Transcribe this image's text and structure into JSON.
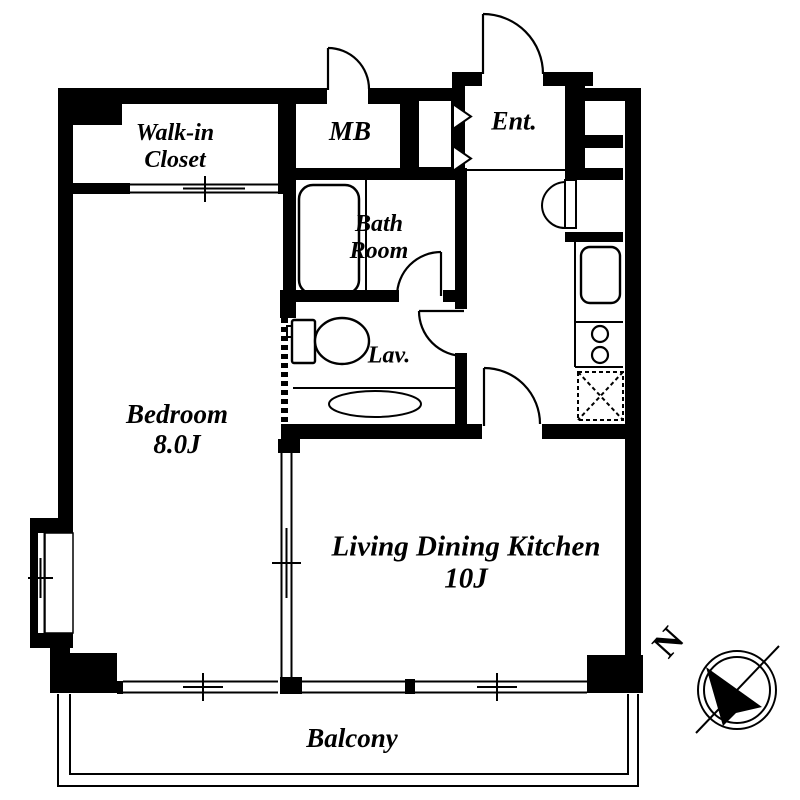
{
  "page": {
    "title": "Apartment Floor Plan"
  },
  "rooms": {
    "walk_in_closet": {
      "line1": "Walk-in",
      "line2": "Closet"
    },
    "meter_box": {
      "label": "MB"
    },
    "entrance": {
      "label": "Ent."
    },
    "bathroom": {
      "line1": "Bath",
      "line2": "Room"
    },
    "lavatory": {
      "label": "Lav."
    },
    "bedroom": {
      "line1": "Bedroom",
      "line2": "8.0J"
    },
    "living_dining_kitchen": {
      "line1": "Living Dining Kitchen",
      "line2": "10J"
    },
    "balcony": {
      "label": "Balcony"
    }
  },
  "compass": {
    "north_label": "N"
  },
  "colors": {
    "line": "#000000",
    "background": "#ffffff"
  }
}
